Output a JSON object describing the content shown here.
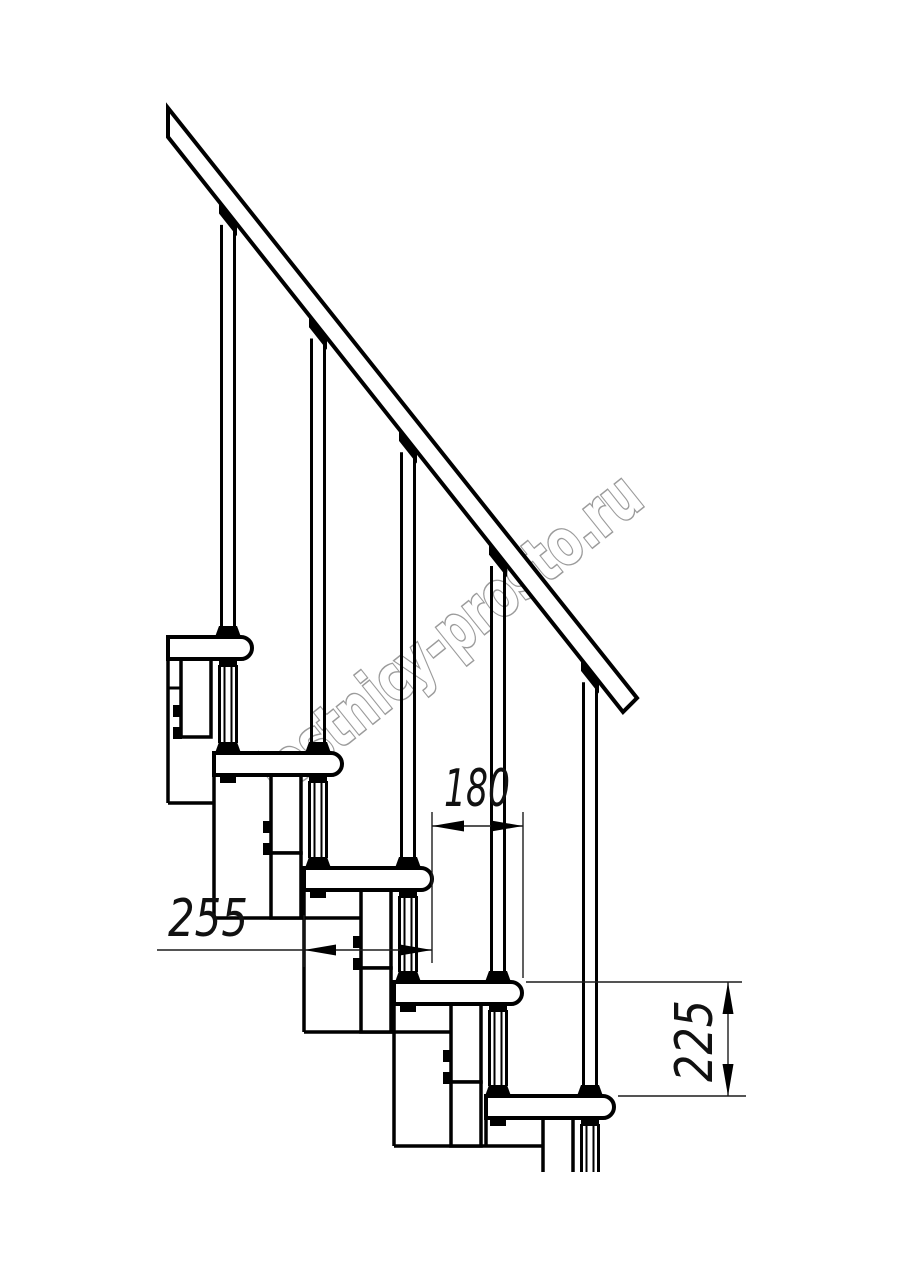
{
  "drawing": {
    "title": "modular-staircase-side-view",
    "colors": {
      "line": "#000000",
      "dim": "#1c1c1c",
      "text": "#111111",
      "watermark_outline": "#9b9b9b",
      "watermark_fill": "#ffffff",
      "background": "#ffffff"
    },
    "watermark": {
      "text": "lestnicy-prosto.ru",
      "center_x": 463,
      "center_y": 651,
      "angle_deg": -38.7,
      "length": 470,
      "font_size": 64
    },
    "stairs": {
      "tread_thickness": 22,
      "treads": [
        {
          "left": 168,
          "nose": 252,
          "top": 637
        },
        {
          "left": 214,
          "nose": 342,
          "top": 753
        },
        {
          "left": 304,
          "nose": 432,
          "top": 868
        },
        {
          "left": 394,
          "nose": 522,
          "top": 982
        },
        {
          "left": 486,
          "nose": 614,
          "top": 1096
        }
      ],
      "baluster_offset_from_nose": 24,
      "rail_polygon": [
        [
          168,
          108
        ],
        [
          637,
          698
        ],
        [
          623,
          712
        ],
        [
          168,
          137
        ]
      ],
      "rail_lower_edge": {
        "x1": 168,
        "y1": 137,
        "x2": 623,
        "y2": 712
      },
      "spine_vlines": [
        [
          168,
          659,
          803
        ],
        [
          214,
          775,
          918
        ],
        [
          304,
          890,
          1032
        ],
        [
          394,
          1004,
          1146
        ],
        [
          486,
          1118,
          1146
        ]
      ],
      "spine_hlines": [
        [
          803,
          168,
          214
        ],
        [
          918,
          214,
          361
        ],
        [
          1032,
          304,
          451
        ],
        [
          1146,
          394,
          543
        ]
      ],
      "left_tick": [
        688,
        168,
        181
      ],
      "box_width": 30,
      "box_offset_from_nose": 71,
      "box_joints": [
        918,
        1032,
        1146
      ],
      "cut_bottom_y": 1172
    },
    "dimensions": [
      {
        "name": "going-180",
        "value": "180",
        "orientation": "horizontal",
        "line_y": 826,
        "from_x": 432,
        "to_x": 523,
        "tail_x": null,
        "ext_lines": [
          [
            432,
            812,
            963
          ],
          [
            523,
            812,
            978
          ]
        ],
        "text_x": 477,
        "text_y": 806,
        "text_length": 66
      },
      {
        "name": "tread-depth-255",
        "value": "255",
        "orientation": "horizontal",
        "line_y": 950,
        "from_x": 304,
        "to_x": 432,
        "tail_x": 157,
        "ext_lines": [
          [
            304,
            915,
            967
          ]
        ],
        "text_x": 208,
        "text_y": 936,
        "text_length": 80
      },
      {
        "name": "rise-225",
        "value": "225",
        "orientation": "vertical",
        "line_x": 728,
        "from_y": 982,
        "to_y": 1096,
        "ext_lines_h": [
          [
            982,
            526,
            742
          ],
          [
            1096,
            618,
            746
          ]
        ],
        "text_x": 712,
        "text_y": 1041,
        "text_length": 82
      }
    ]
  }
}
